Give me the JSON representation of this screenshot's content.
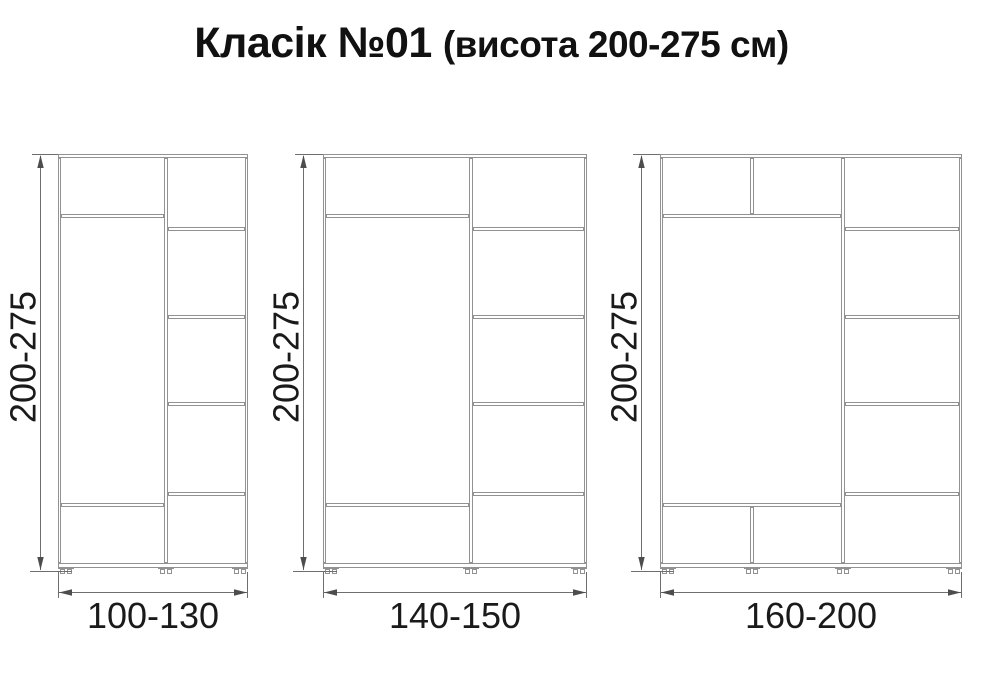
{
  "title": {
    "main": "Класік №01",
    "sub": "(висота 200-275 см)"
  },
  "colors": {
    "background": "#ffffff",
    "cabinet_line": "#929292",
    "dimension_line": "#6e6e6e",
    "arrow": "#4d4d4d",
    "text": "#1a1a1a"
  },
  "diagram": {
    "canvas": {
      "width": 983,
      "height": 700
    },
    "height_label": "200-275",
    "vertical": {
      "cab_top": 154,
      "top_panel_h": 4,
      "wall_top": 158,
      "bottom_panel_y": 563,
      "bottom_panel_h": 5,
      "left_shelf_top": 214,
      "left_shelf_bottom": 503,
      "right_shelves": [
        227,
        315,
        402,
        492
      ],
      "shelf_h": 4,
      "feet_y": 568,
      "bottom_ext_y": 571,
      "hdim_y": 592,
      "ext_end_y": 598,
      "hlabel_baseline_y": 628,
      "vlabel_center_y": 357,
      "label_font_size": 36
    },
    "wardrobes": [
      {
        "name": "wardrobe-100-130",
        "width_label": "100-130",
        "x": 58,
        "right": 248,
        "divider": 164,
        "dim_x": 40,
        "feet": [
          66,
          166,
          240
        ],
        "top_split": null,
        "bottom_split": null
      },
      {
        "name": "wardrobe-140-150",
        "width_label": "140-150",
        "x": 323,
        "right": 587,
        "divider": 469,
        "dim_x": 303,
        "feet": [
          331,
          471,
          579
        ],
        "top_split": null,
        "bottom_split": null
      },
      {
        "name": "wardrobe-160-200",
        "width_label": "160-200",
        "x": 660,
        "right": 962,
        "divider": 841,
        "dim_x": 641,
        "feet": [
          668,
          752,
          843,
          954
        ],
        "top_split": 750,
        "bottom_split": 750
      }
    ]
  }
}
